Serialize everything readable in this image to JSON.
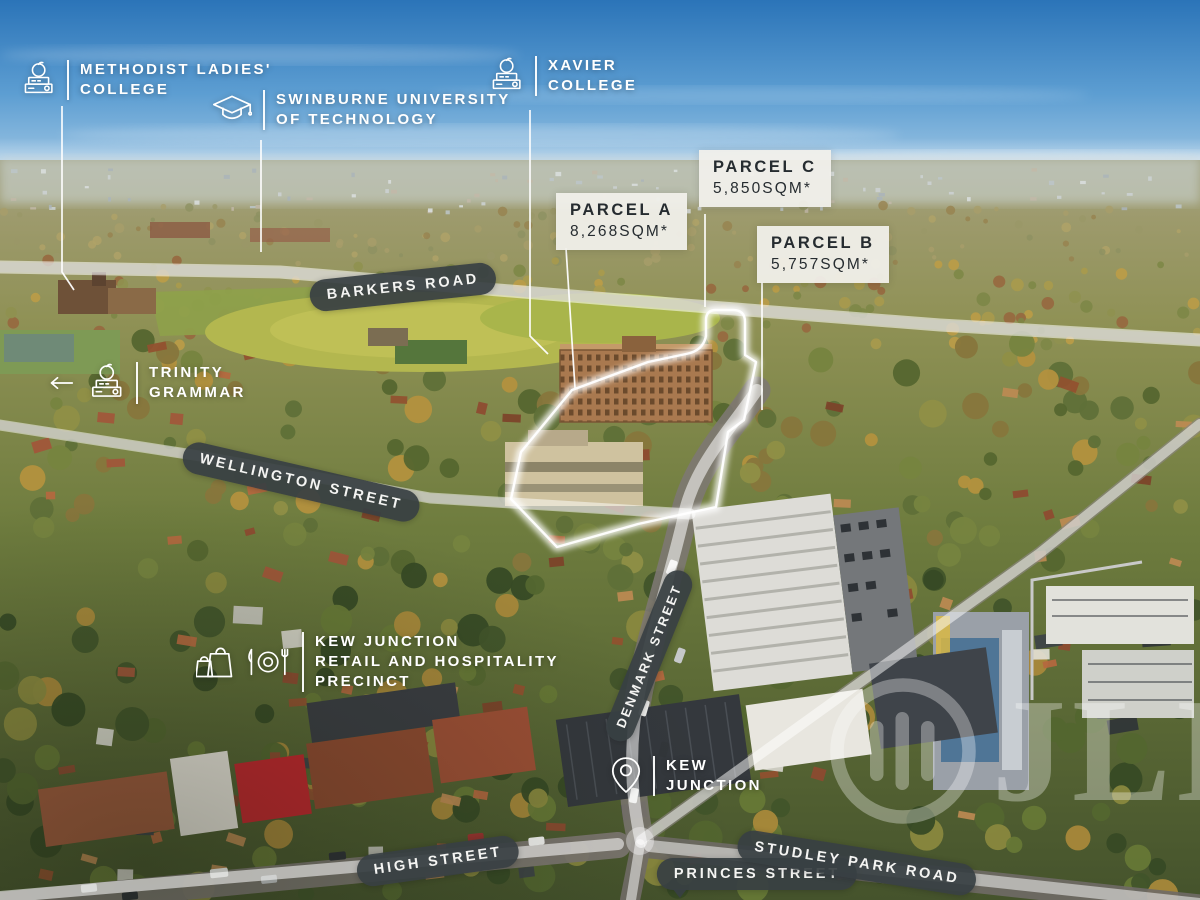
{
  "labels": {
    "mlc": {
      "line1": "METHODIST LADIES'",
      "line2": "COLLEGE"
    },
    "swinburne": {
      "line1": "SWINBURNE UNIVERSITY",
      "line2": "OF TECHNOLOGY"
    },
    "xavier": {
      "line1": "XAVIER",
      "line2": "COLLEGE"
    },
    "trinity": {
      "line1": "TRINITY",
      "line2": "GRAMMAR"
    },
    "precinct": {
      "line1": "KEW JUNCTION",
      "line2": "RETAIL AND HOSPITALITY",
      "line3": "PRECINCT"
    },
    "kew_junction": {
      "line1": "KEW",
      "line2": "JUNCTION"
    }
  },
  "parcels": {
    "a": {
      "name": "PARCEL A",
      "area": "8,268SQM*"
    },
    "c": {
      "name": "PARCEL C",
      "area": "5,850SQM*"
    },
    "b": {
      "name": "PARCEL B",
      "area": "5,757SQM*"
    }
  },
  "streets": {
    "barkers": "BARKERS ROAD",
    "wellington": "WELLINGTON STREET",
    "denmark": "DENMARK STREET",
    "high": "HIGH STREET",
    "princes": "PRINCES STREET",
    "studley": "STUDLEY PARK ROAD"
  },
  "watermark": {
    "text": "JLL"
  },
  "icons": {
    "mlc": "school-icon",
    "swinburne": "graduation-cap-icon",
    "xavier": "school-icon",
    "trinity": "school-icon",
    "trinity_arrow": "arrow-left-icon",
    "precinct_1": "shopping-bag-icon",
    "precinct_2": "dining-icon",
    "kew_junction": "map-pin-icon",
    "watermark": "jll-logo-mark"
  },
  "colors": {
    "pill_bg": "#383f43",
    "pill_text": "#f4f4f2",
    "parcel_box_bg": "#f1f0eb",
    "parcel_text": "#262c30",
    "poi_text": "#ffffff",
    "road_highlight": "#ffffff",
    "sky_top": "#2f7cc0",
    "sky_horizon": "#bcd7ea"
  }
}
